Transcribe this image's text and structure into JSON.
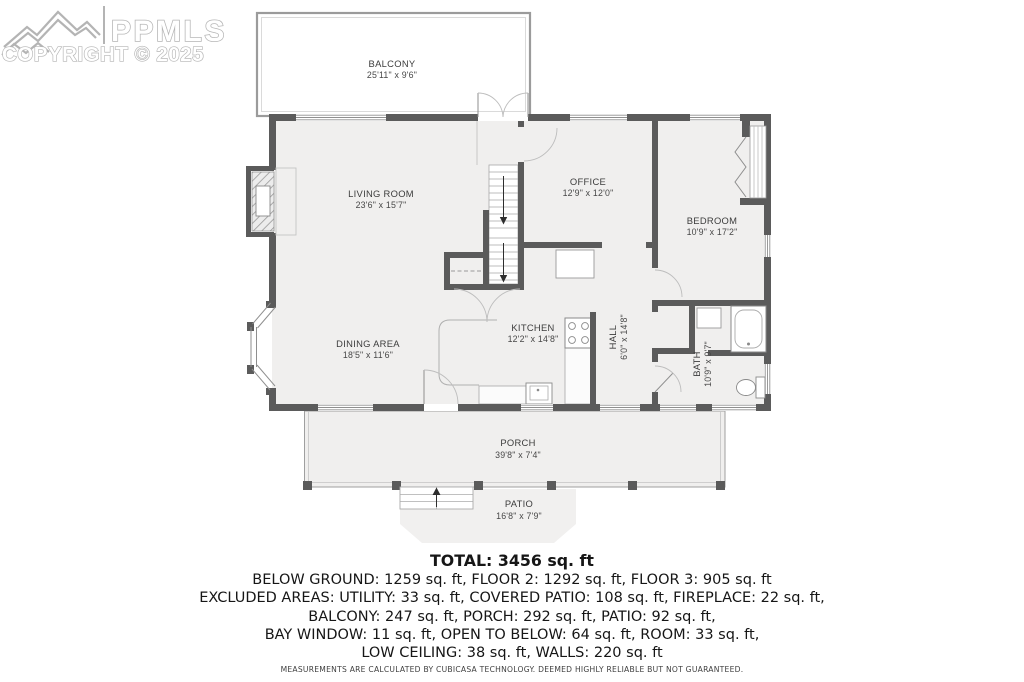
{
  "watermark": {
    "brand": "PPMLS",
    "copyright": "COPYRIGHT © 2025"
  },
  "floorplan": {
    "rooms": {
      "balcony": {
        "name": "BALCONY",
        "dims": "25'11\" x 9'6\""
      },
      "living": {
        "name": "LIVING ROOM",
        "dims": "23'6\" x 15'7\""
      },
      "office": {
        "name": "OFFICE",
        "dims": "12'9\" x 12'0\""
      },
      "bedroom": {
        "name": "BEDROOM",
        "dims": "10'9\" x 17'2\""
      },
      "dining": {
        "name": "DINING AREA",
        "dims": "18'5\" x 11'6\""
      },
      "kitchen": {
        "name": "KITCHEN",
        "dims": "12'2\" x 14'8\""
      },
      "hall": {
        "name": "HALL",
        "dims": "6'0\" x 14'8\""
      },
      "bath": {
        "name": "BATH",
        "dims": "10'9\" x 9'7\""
      },
      "porch": {
        "name": "PORCH",
        "dims": "39'8\" x 7'4\""
      },
      "patio": {
        "name": "PATIO",
        "dims": "16'8\" x 7'9\""
      }
    }
  },
  "summary": {
    "total": "TOTAL: 3456 sq. ft",
    "line1": "BELOW GROUND: 1259 sq. ft, FLOOR 2: 1292 sq. ft, FLOOR 3: 905 sq. ft",
    "line2": "EXCLUDED AREAS: UTILITY: 33 sq. ft, COVERED PATIO: 108 sq. ft, FIREPLACE: 22 sq. ft,",
    "line3": "BALCONY: 247 sq. ft, PORCH: 292 sq. ft, PATIO: 92 sq. ft,",
    "line4": "BAY WINDOW: 11 sq. ft, OPEN TO BELOW: 64 sq. ft, ROOM: 33 sq. ft,",
    "line5": "LOW CEILING: 38 sq. ft, WALLS: 220 sq. ft",
    "disclaimer": "MEASUREMENTS ARE CALCULATED BY CUBICASA TECHNOLOGY. DEEMED HIGHLY RELIABLE BUT NOT GUARANTEED."
  },
  "colors": {
    "wall": "#5b5b5b",
    "floor": "#f0efee",
    "thin_line": "#9c9c9c",
    "label_text": "#3c3c3c",
    "watermark": "#b4b4b4"
  }
}
